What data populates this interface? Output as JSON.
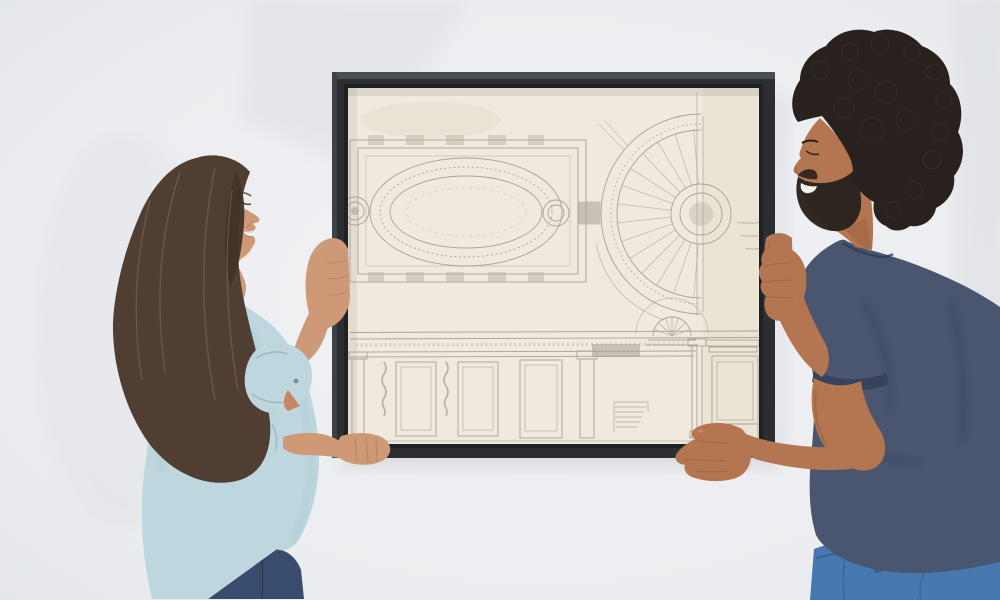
{
  "scene": {
    "setting": "bright room with plain light gray wall",
    "action": "couple hanging a large framed architectural drawing together",
    "people": {
      "woman": {
        "position": "left",
        "expression": "laughing, eyes closed",
        "hair": "long dark brown hair",
        "clothing_top": "light blue long-sleeve shirt with rolled cuffs",
        "clothing_bottom": "dark blue jeans",
        "hands": "left hand gripping the frame's left edge, right hand supporting the frame bottom"
      },
      "man": {
        "position": "right",
        "expression": "smiling",
        "hair": "dark curly afro with short beard",
        "clothing_top": "navy blue t-shirt",
        "clothing_bottom": "medium blue jeans",
        "hands": "right hand gripping the frame's right edge, left hand supporting the frame bottom"
      }
    },
    "artwork": {
      "type": "framed architectural drawing in pencil",
      "frame": "thin black gallery frame",
      "paper": "cream aged paper",
      "subjects": [
        "oval ceiling plan with end medallions",
        "semicircular coffered dome fan plan",
        "wall paneling elevation with pilasters, stair hatching and arched niche"
      ],
      "annotation": "faint illegible pencil handwriting at right margin"
    }
  },
  "palette": {
    "wall": "#eef0f2",
    "wall_shade": "#d9dcdf",
    "frame": "#27292c",
    "frame_bevel": "#46494e",
    "frame_lip": "#1a1c1e",
    "paper": "#f2ecdf",
    "paper_shade": "#e7dfcd",
    "pencil": "#a49a8c",
    "pencil_shade": "#988e80",
    "shadow": "#8e959e",
    "woman_skin": "#d09873",
    "woman_skin_shade": "#b5734e",
    "woman_hair": "#4c3a2d",
    "woman_hair_light": "#8a6c53",
    "woman_shirt": "#bfd8de",
    "woman_shirt_shade": "#9dbfc8",
    "woman_jeans": "#33496b",
    "man_skin": "#b4744c",
    "man_skin_shade": "#8c5231",
    "man_hair": "#231c17",
    "man_hair_light": "#3b322a",
    "man_shirt": "#46526d",
    "man_shirt_shade": "#333d56",
    "man_jeans": "#4377af",
    "man_jeans_dark": "#2e568c",
    "teeth": "#f7f2ea",
    "lips": "#a55f49"
  }
}
